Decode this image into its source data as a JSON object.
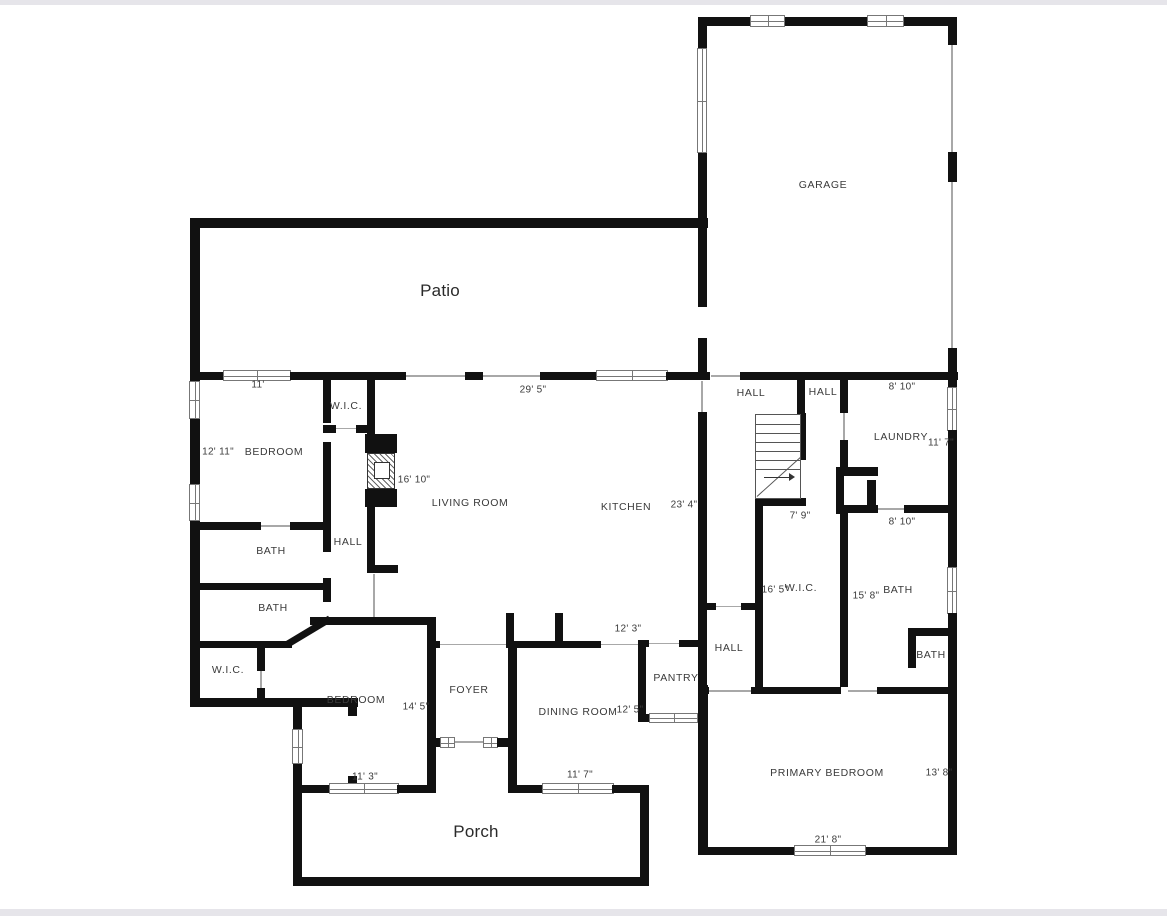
{
  "plan_title": "Floor plan",
  "colors": {
    "wall": "#111111",
    "background": "#ffffff",
    "frame_bar": "#e6e5ea",
    "label_text": "#3a3a3a"
  },
  "rooms": {
    "garage": "GARAGE",
    "patio": "Patio",
    "wic_top": "W.I.C.",
    "bedroom1": "BEDROOM",
    "living": "LIVING ROOM",
    "kitchen": "KITCHEN",
    "hall1": "HALL",
    "hall2": "HALL",
    "laundry": "LAUNDRY",
    "hall3": "HALL",
    "bath1": "BATH",
    "bath2": "BATH",
    "wic2": "W.I.C.",
    "bedroom2": "BEDROOM",
    "foyer": "FOYER",
    "dining": "DINING ROOM",
    "pantry": "PANTRY",
    "hall4": "HALL",
    "wic3": "W.I.C.",
    "bath3": "BATH",
    "bath4": "BATH",
    "primary": "PRIMARY BEDROOM",
    "porch": "Porch"
  },
  "dimensions": {
    "d11": "11'",
    "d29_5": "29' 5\"",
    "d8_10a": "8' 10\"",
    "d12_11": "12' 11\"",
    "d11_7a": "11' 7\"",
    "d16_10": "16' 10\"",
    "d23_4": "23' 4\"",
    "d7_9": "7' 9\"",
    "d8_10b": "8' 10\"",
    "d16_5": "16' 5\"",
    "d15_8": "15' 8\"",
    "d12_3": "12' 3\"",
    "d12_5": "12' 5\"",
    "d14_5": "14' 5\"",
    "d11_3": "11' 3\"",
    "d11_7b": "11' 7\"",
    "d13_8": "13' 8\"",
    "d21_8": "21' 8\""
  }
}
